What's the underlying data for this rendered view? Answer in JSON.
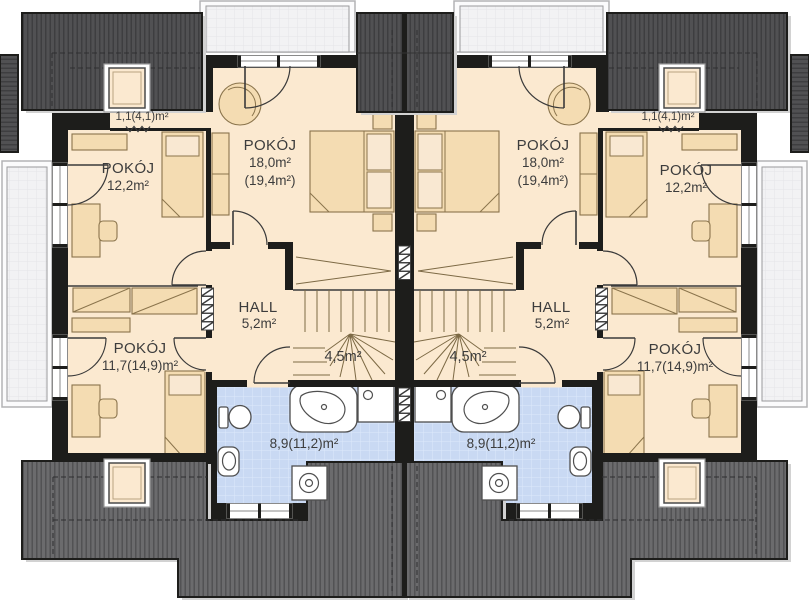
{
  "colors": {
    "wall": "#1d1d1b",
    "floor": "#fbe9d0",
    "furniture": "#f4dcb2",
    "furniture_stroke": "#8a744c",
    "bathroom_floor": "#c9d9f3",
    "roof_dark": "#515153",
    "roof_light": "#6b6b6d",
    "balcony": "#f2f2f4",
    "fixture_stroke": "#4f4f4f",
    "door_arc": "#3a3a3a",
    "text": "#3c3c3c"
  },
  "houses": {
    "left": {
      "bedroom_large": {
        "name": "POKÓJ",
        "area": "18,0m²",
        "area_with_slopes": "(19,4m²)"
      },
      "bedroom_front": {
        "name": "POKÓJ",
        "area": "12,2m²"
      },
      "bedroom_back": {
        "name": "POKÓJ",
        "area": "11,7(14,9)m²"
      },
      "hall": {
        "name": "HALL",
        "area": "5,2m²"
      },
      "staircase": {
        "area": "4,5m²"
      },
      "bathroom": {
        "area": "8,9(11,2)m²"
      },
      "attic_niche": {
        "area": "1,1(4,1)m²"
      }
    },
    "right": {
      "bedroom_large": {
        "name": "POKÓJ",
        "area": "18,0m²",
        "area_with_slopes": "(19,4m²)"
      },
      "bedroom_front": {
        "name": "POKÓJ",
        "area": "12,2m²"
      },
      "bedroom_back": {
        "name": "POKÓJ",
        "area": "11,7(14,9)m²"
      },
      "hall": {
        "name": "HALL",
        "area": "5,2m²"
      },
      "staircase": {
        "area": "4,5m²"
      },
      "bathroom": {
        "area": "8,9(11,2)m²"
      },
      "attic_niche": {
        "area": "1,1(4,1)m²"
      }
    }
  }
}
